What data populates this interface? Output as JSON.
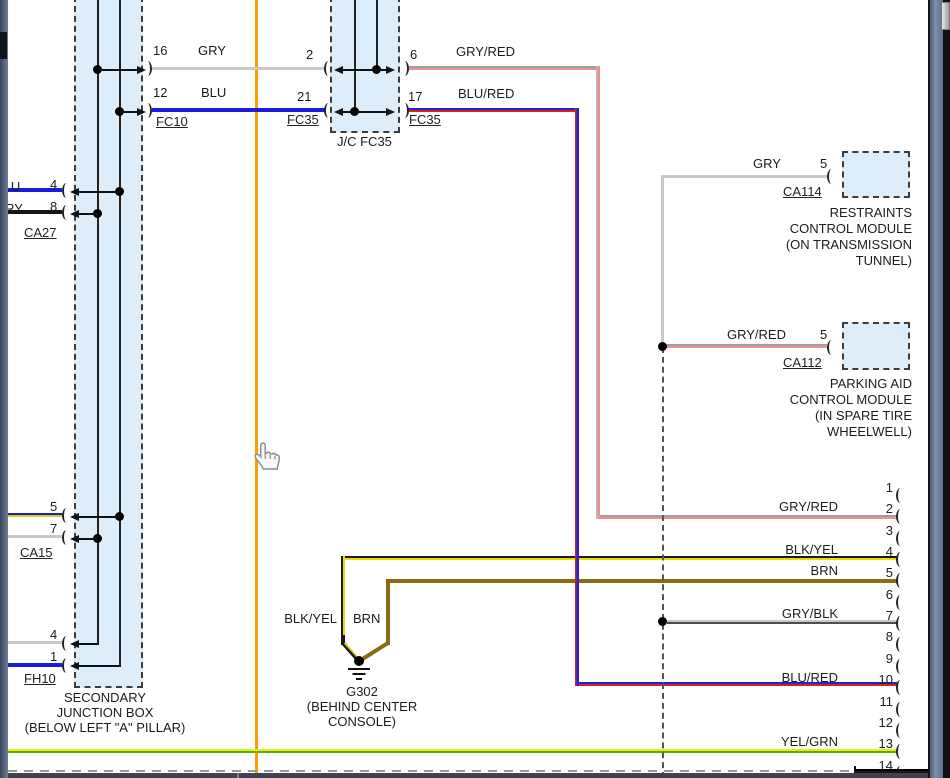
{
  "wires": {
    "gry": "GRY",
    "blu": "BLU",
    "gryred": "GRY/RED",
    "blured": "BLU/RED",
    "blkyel": "BLK/YEL",
    "brn": "BRN",
    "gryblk": "GRY/BLK",
    "yelgrn": "YEL/GRN"
  },
  "connectors": {
    "fc10": {
      "label": "FC10",
      "pins": [
        {
          "n": "16",
          "wire": "GRY"
        },
        {
          "n": "12",
          "wire": "BLU"
        }
      ]
    },
    "fc35_left": {
      "label": "FC35",
      "pins": [
        {
          "n": "2"
        },
        {
          "n": "21"
        }
      ]
    },
    "jc_fc35": {
      "label": "J/C FC35"
    },
    "fc35_right": {
      "label": "FC35",
      "pins": [
        {
          "n": "6",
          "wire": "GRY/RED"
        },
        {
          "n": "17",
          "wire": "BLU/RED"
        }
      ]
    },
    "ca27": {
      "label": "CA27",
      "pins": [
        {
          "n": "4",
          "wire": "BLU"
        },
        {
          "n": "8",
          "wire": "GRY"
        }
      ]
    },
    "ca15": {
      "label": "CA15",
      "pins": [
        {
          "n": "5"
        },
        {
          "n": "7"
        }
      ]
    },
    "fh10": {
      "label": "FH10",
      "pins": [
        {
          "n": "4"
        },
        {
          "n": "1"
        }
      ]
    },
    "ca114": {
      "label": "CA114",
      "pin": "5",
      "wire": "GRY",
      "module": [
        "RESTRAINTS",
        "CONTROL MODULE",
        "(ON TRANSMISSION",
        "TUNNEL)"
      ]
    },
    "ca112": {
      "label": "CA112",
      "pin": "5",
      "wire": "GRY/RED",
      "module": [
        "PARKING AID",
        "CONTROL MODULE",
        "(IN SPARE TIRE",
        "WHEELWELL)"
      ]
    }
  },
  "junction_box": {
    "name_lines": [
      "SECONDARY",
      "JUNCTION BOX",
      "(BELOW LEFT \"A\" PILLAR)"
    ]
  },
  "ground": {
    "label": "G302",
    "location_lines": [
      "(BEHIND CENTER",
      "CONSOLE)"
    ],
    "wire_left": "BLK/YEL",
    "wire_right": "BRN"
  },
  "right_connector": {
    "pins": [
      {
        "n": "1"
      },
      {
        "n": "2",
        "wire": "GRY/RED"
      },
      {
        "n": "3"
      },
      {
        "n": "4",
        "wire": "BLK/YEL"
      },
      {
        "n": "5",
        "wire": "BRN"
      },
      {
        "n": "6"
      },
      {
        "n": "7",
        "wire": "GRY/BLK"
      },
      {
        "n": "8"
      },
      {
        "n": "9"
      },
      {
        "n": "10",
        "wire": "BLU/RED"
      },
      {
        "n": "11"
      },
      {
        "n": "12"
      },
      {
        "n": "13",
        "wire": "YEL/GRN"
      },
      {
        "n": "14"
      }
    ],
    "layout": {
      "top": 481,
      "step": 21.35,
      "num_right": 893,
      "arc_x": 896,
      "label_right": 838
    }
  },
  "colors": {
    "trace_highlight": "#ff9e00",
    "box_fill": "#ddedf9",
    "gry": "#c9c9c9",
    "blu": "#1a1ae0",
    "brn": "#8a6c17",
    "blk": "#161616",
    "red": "#d62121",
    "yel": "#e6df00",
    "grn": "#58b000"
  }
}
